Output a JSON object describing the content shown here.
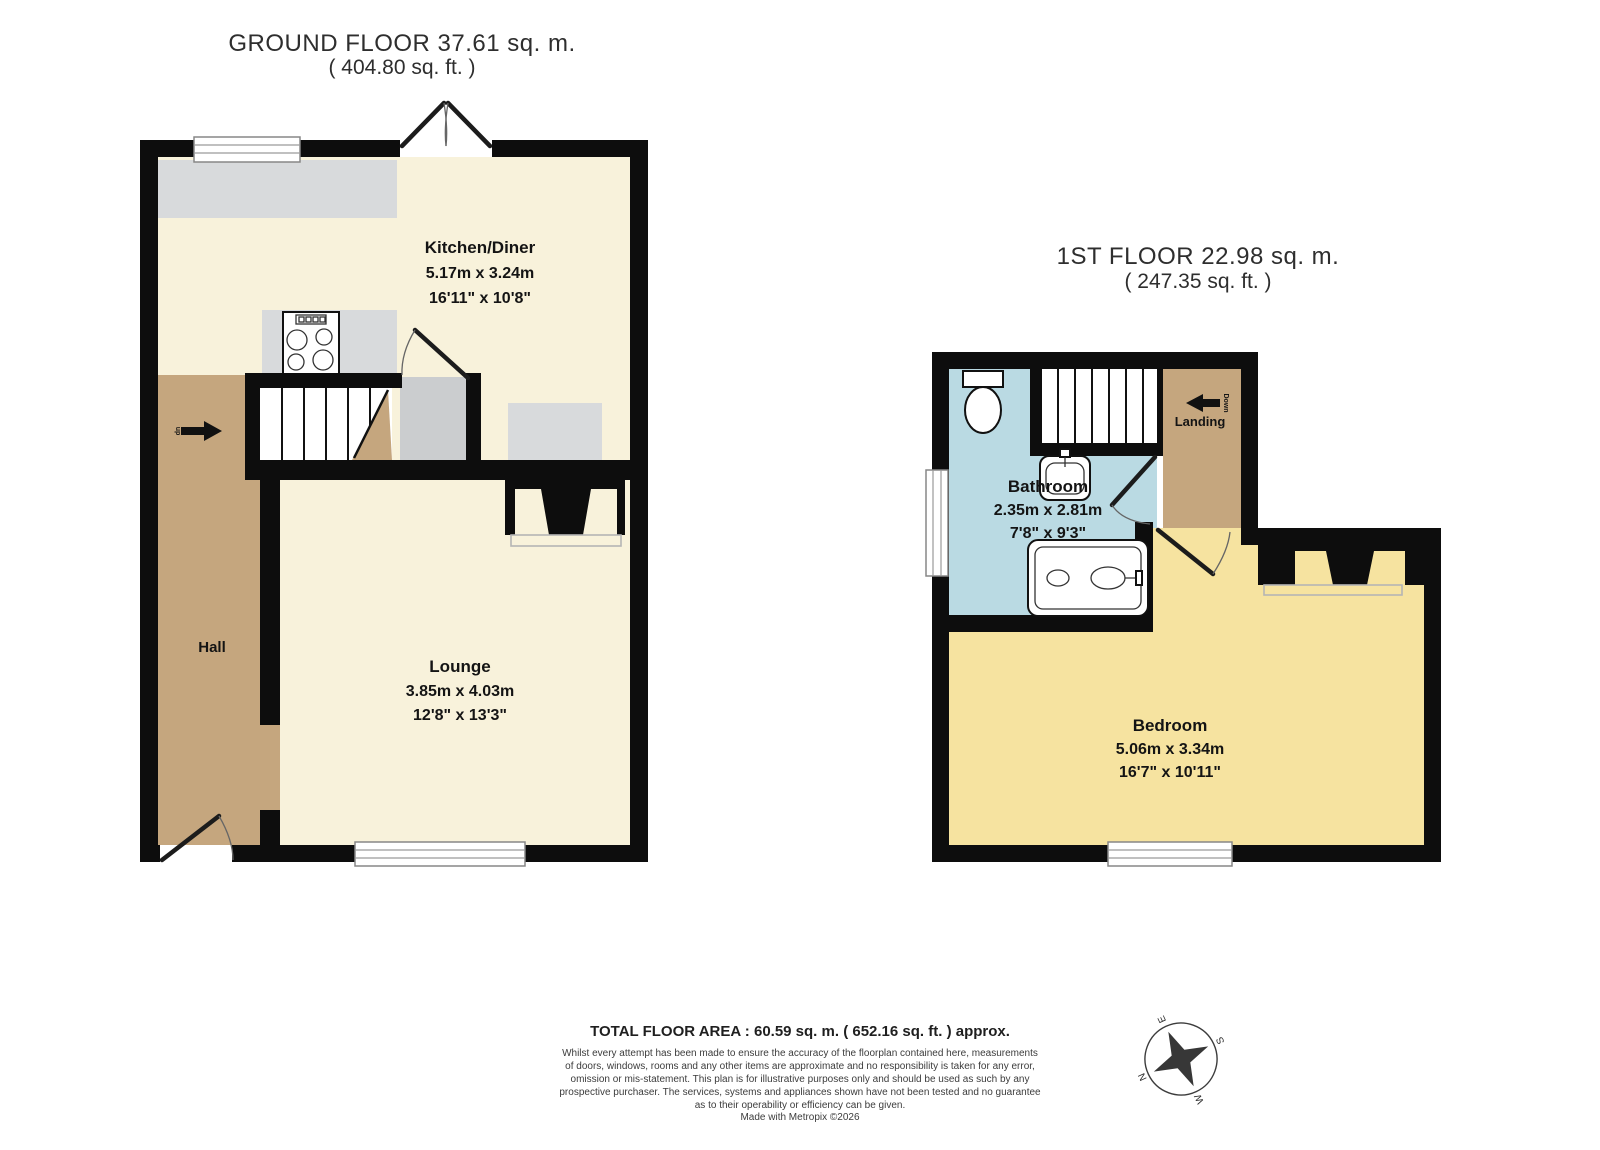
{
  "ground_floor": {
    "title": "GROUND FLOOR 37.61 sq. m.",
    "subtitle": "( 404.80 sq. ft. )",
    "rooms": {
      "kitchen": {
        "name": "Kitchen/Diner",
        "size_m": "5.17m x 3.24m",
        "size_ft": "16'11\" x 10'8\""
      },
      "lounge": {
        "name": "Lounge",
        "size_m": "3.85m x 4.03m",
        "size_ft": "12'8\" x 13'3\""
      },
      "hall": {
        "name": "Hall"
      }
    },
    "stairs_direction": "up"
  },
  "first_floor": {
    "title": "1ST FLOOR 22.98 sq. m.",
    "subtitle": "( 247.35 sq. ft. )",
    "rooms": {
      "bathroom": {
        "name": "Bathroom",
        "size_m": "2.35m x 2.81m",
        "size_ft": "7'8\" x 9'3\""
      },
      "bedroom": {
        "name": "Bedroom",
        "size_m": "5.06m x 3.34m",
        "size_ft": "16'7\" x 10'11\""
      },
      "landing": {
        "name": "Landing",
        "stairs_direction": "Down"
      }
    }
  },
  "footer": {
    "total_area": "TOTAL FLOOR AREA : 60.59 sq. m. ( 652.16 sq. ft. ) approx.",
    "disclaimer_lines": [
      "Whilst every attempt has been made to ensure the accuracy of the floorplan contained here, measurements",
      "of doors, windows, rooms and any other items are approximate and no responsibility is taken for any error,",
      "omission or mis-statement. This plan is for illustrative purposes only and should be used as such by any",
      "prospective purchaser. The services, systems and appliances shown have not been tested and no guarantee",
      "as to their operability or efficiency can be given."
    ],
    "credit": "Made with Metropix ©2026"
  },
  "compass": {
    "north": "N",
    "east": "E",
    "south": "S",
    "west": "W"
  },
  "colors": {
    "wall": "#0d0d0d",
    "kitchen_lounge_floor": "#f8f2db",
    "hall_floor": "#c5a67e",
    "bathroom_floor": "#badae3",
    "bedroom_floor": "#f6e3a0",
    "landing_floor": "#c5a67e",
    "counter_grey": "#d8dadc",
    "cupboard_grey": "#cbcdcf"
  }
}
